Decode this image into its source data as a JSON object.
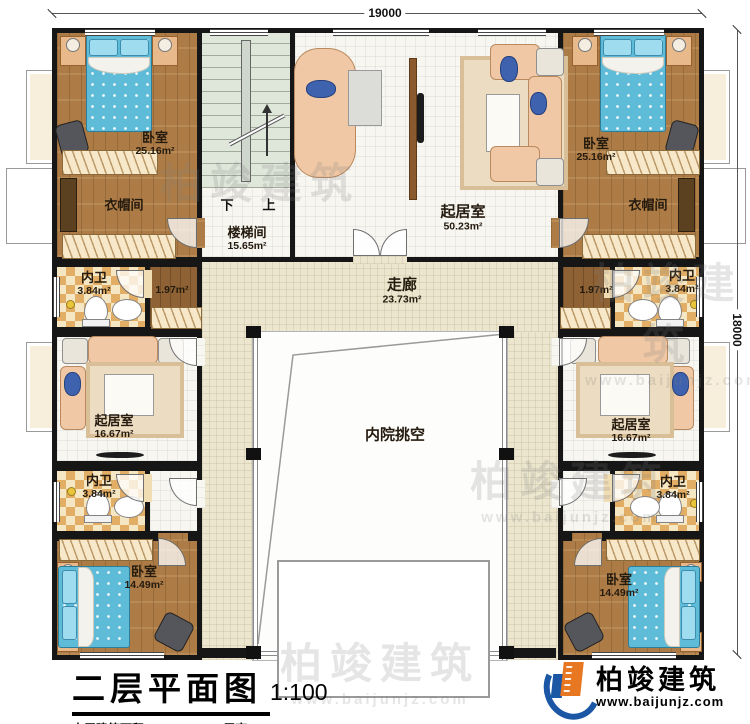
{
  "dimensions": {
    "top": "19000",
    "right": "18000"
  },
  "rooms": {
    "bedroom_tl": {
      "name": "卧室",
      "area": "25.16m²"
    },
    "bedroom_tr": {
      "name": "卧室",
      "area": "25.16m²"
    },
    "bedroom_bl": {
      "name": "卧室",
      "area": "14.49m²"
    },
    "bedroom_br": {
      "name": "卧室",
      "area": "14.49m²"
    },
    "cloak_l": {
      "name": "衣帽间"
    },
    "cloak_r": {
      "name": "衣帽间"
    },
    "stair": {
      "name": "楼梯间",
      "area": "15.65m²",
      "down": "下",
      "up": "上"
    },
    "living_top": {
      "name": "起居室",
      "area": "50.23m²"
    },
    "living_l": {
      "name": "起居室",
      "area": "16.67m²"
    },
    "living_r": {
      "name": "起居室",
      "area": "16.67m²"
    },
    "bath_tl": {
      "name": "内卫",
      "area": "3.84m²"
    },
    "bath_tr": {
      "name": "内卫",
      "area": "3.84m²"
    },
    "bath_bl": {
      "name": "内卫",
      "area": "3.84m²"
    },
    "bath_br": {
      "name": "内卫",
      "area": "3.84m²"
    },
    "hall_l": {
      "area": "1.97m²"
    },
    "hall_r": {
      "area": "1.97m²"
    },
    "corridor": {
      "name": "走廊",
      "area": "23.73m²"
    },
    "courtyard": {
      "name": "内院挑空"
    }
  },
  "title": {
    "main": "二层平面图",
    "scale": "1:100",
    "floor_area": "本层建筑面积：255.35m²",
    "floor_height": "层高：3.60m"
  },
  "logo": {
    "name": "柏竣建筑",
    "site": "www.baijunjz.com"
  },
  "watermark": {
    "name": "柏竣建筑",
    "site": "www.baijunjz.com"
  },
  "colors": {
    "wall": "#161616",
    "wood": "#ad7c46",
    "corridor_floor": "#ece6cf",
    "bath_tile": "#e2ae66",
    "stair_floor": "#dfe6da",
    "bed_blue": "#5fbcd8",
    "sofa_peach": "#f0c8a5",
    "logo_blue": "#1b57a5",
    "logo_orange": "#e87722"
  }
}
